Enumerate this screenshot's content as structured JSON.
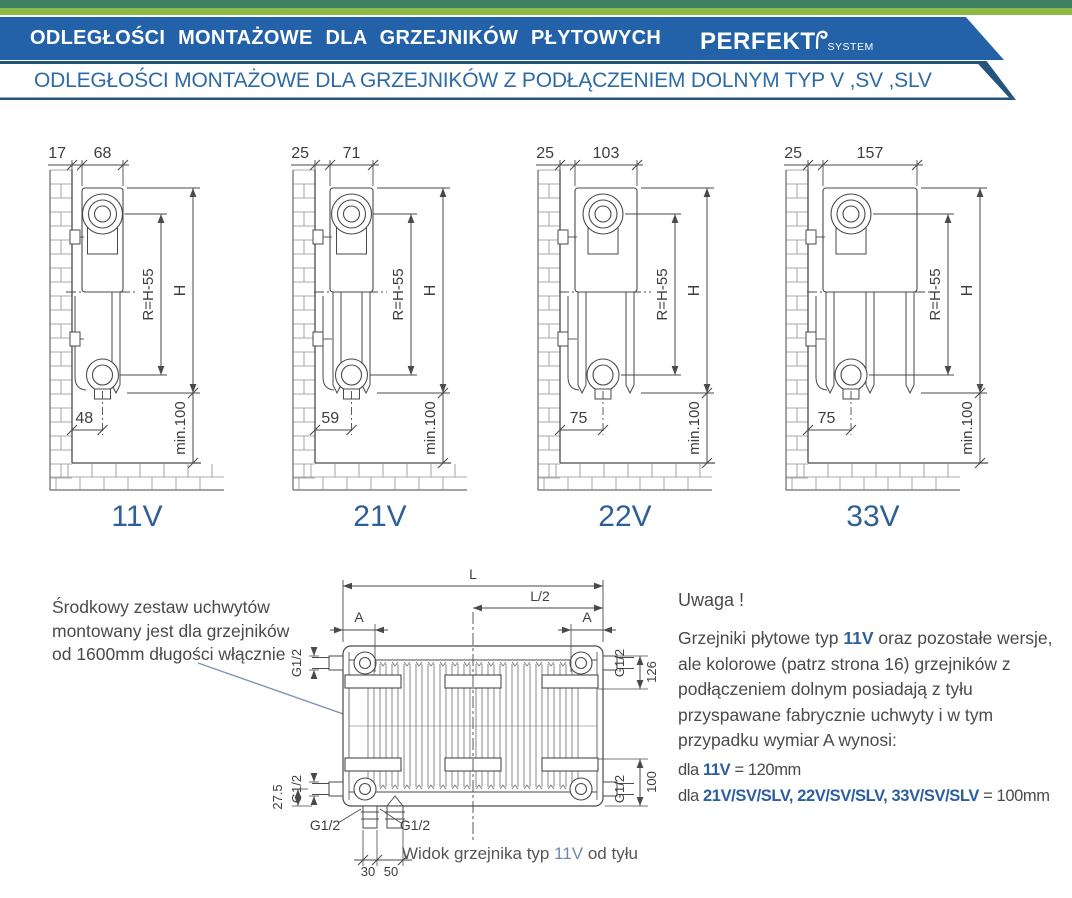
{
  "header": {
    "title": "ODLEGŁOŚCI MONTAŻOWE DLA GRZEJNIKÓW PŁYTOWYCH",
    "brand": "PERFEKT",
    "brand_suffix": "SYSTEM"
  },
  "subheader": {
    "title": "ODLEGŁOŚCI MONTAŻOWE DLA GRZEJNIKÓW Z PODŁĄCZENIEM DOLNYM TYP V ,SV ,SLV"
  },
  "colors": {
    "banner_blue": "#2362a9",
    "outline_navy": "#27547e",
    "strip_dark_green": "#3f7f63",
    "strip_light_green": "#8cba45",
    "accent_blue": "#2d5f9e",
    "drawing_line": "#4a4a4a",
    "leader_blue": "#7f95b2"
  },
  "diagrams": [
    {
      "type_label": "11V",
      "wall_offset": "17",
      "depth": "68",
      "bottom_offset": "48",
      "r_label": "R=H-55",
      "h_label": "H",
      "min_label": "min.100",
      "panels": 1
    },
    {
      "type_label": "21V",
      "wall_offset": "25",
      "depth": "71",
      "bottom_offset": "59",
      "r_label": "R=H-55",
      "h_label": "H",
      "min_label": "min.100",
      "panels": 2
    },
    {
      "type_label": "22V",
      "wall_offset": "25",
      "depth": "103",
      "bottom_offset": "75",
      "r_label": "R=H-55",
      "h_label": "H",
      "min_label": "min.100",
      "panels": 2
    },
    {
      "type_label": "33V",
      "wall_offset": "25",
      "depth": "157",
      "bottom_offset": "75",
      "r_label": "R=H-55",
      "h_label": "H",
      "min_label": "min.100",
      "panels": 3
    }
  ],
  "rear_view": {
    "dims": {
      "l": "L",
      "l2": "L/2",
      "a": "A",
      "g": "G1/2",
      "d126": "126",
      "d100": "100",
      "d275": "27.5",
      "d30": "30",
      "d50": "50"
    },
    "caption_pre": "Widok grzejnika typ ",
    "caption_type": "11V",
    "caption_post": " od tyłu"
  },
  "left_note": {
    "lines": [
      "Środkowy zestaw uchwytów",
      "montowany jest dla grzejników",
      "od 1600mm długości włącznie"
    ]
  },
  "note": {
    "title": "Uwaga !",
    "body_pre": "Grzejniki płytowe typ ",
    "body_type": "11V",
    "body_post": " oraz pozostałe wersje, ale kolorowe (patrz strona 16) grzejników z podłączeniem dolnym posiadają z tyłu przyspawane fabrycznie uchwyty i w tym przypadku wymiar A wynosi:",
    "a1_pre": "dla ",
    "a1_type": "11V",
    "a1_val": " = 120mm",
    "a2_pre": "dla ",
    "a2_type": "21V/SV/SLV, 22V/SV/SLV, 33V/SV/SLV",
    "a2_val": " = 100mm"
  }
}
